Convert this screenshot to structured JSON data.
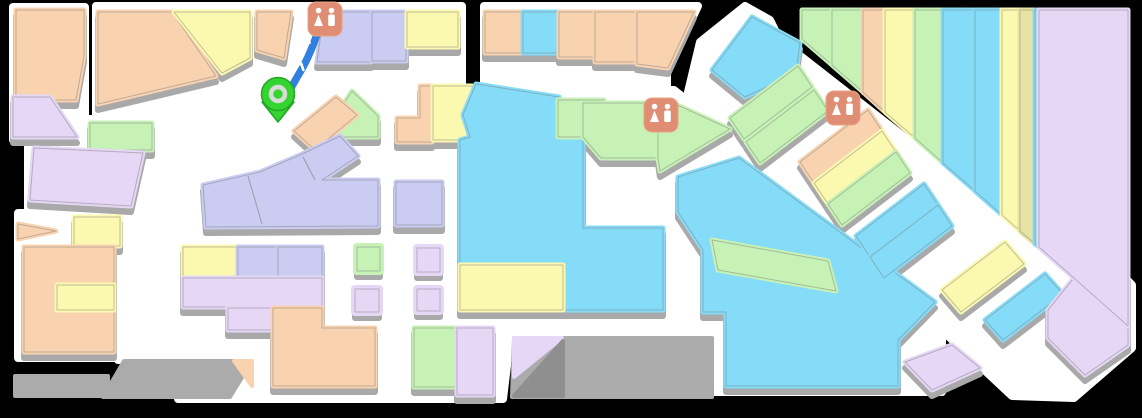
{
  "map": {
    "title": "mall-floor-map",
    "background": "#000000",
    "colors": {
      "peach": "#F9D3B0",
      "yellow": "#FBF8AF",
      "peri": "#CACCF2",
      "lilac": "#E7D7F6",
      "green": "#C7F2B6",
      "blue": "#85DCF8",
      "khaki": "#E6E3A3",
      "gray": "#ABABAB",
      "graydark": "#8F8F8F",
      "white": "#FFFFFF",
      "shadow": "#A9A9A9",
      "outline": "rgba(120,120,120,0.45)",
      "route": "#2F80E0",
      "pin": "#35D531",
      "pin_dark": "#23A623",
      "pin_ring": "#DADADA",
      "restroom_bg": "#DF8E73",
      "restroom_border": "#EBA184",
      "restroom_glyph": "#FFFFFF"
    },
    "floors": [
      {
        "p": "13,7 85,7 85,140 13,140"
      },
      {
        "p": "87,119 156,119 156,153 87,153"
      },
      {
        "p": "28,145 148,145 148,210 28,210"
      },
      {
        "p": "18,213 126,213 126,358 18,358"
      },
      {
        "p": "96,6 256,6 256,170 152,170 96,118"
      },
      {
        "p": "250,6 462,6 462,108 250,108"
      },
      {
        "p": "484,6 698,6 667,72 667,105 484,105"
      },
      {
        "p": "118,100 714,100 714,340 510,340 503,399 178,399 178,360 118,360"
      },
      {
        "p": "556,90 674,90 745,146 942,288 942,392 698,392 698,312 658,312 658,232 581,232 581,142 556,142"
      },
      {
        "p": "700,42 745,6 770,20 780,40 1072,268 1110,262 1132,285 1132,348 1074,398 1012,396 688,92"
      }
    ],
    "ramps": [
      {
        "c": "gray",
        "p": "15,376 108,376 108,396 15,396"
      },
      {
        "c": "gray",
        "p": "124,361 252,361 230,397 103,397"
      },
      {
        "c": "peach",
        "p": "234,361 252,361 252,386"
      },
      {
        "c": "gray",
        "p": "514,338 712,338 712,397 512,397"
      },
      {
        "c": "lilac",
        "p": "514,338 562,338 514,377"
      },
      {
        "c": "graydark",
        "p": "514,396 563,341 563,396"
      }
    ],
    "blocks": [
      {
        "c": "peach",
        "p": "16,10 84,10 84,56 76,100 16,100"
      },
      {
        "c": "lilac",
        "p": "13,97 50,97 77,137 13,137"
      },
      {
        "c": "green",
        "p": "90,123 152,123 152,150 90,150"
      },
      {
        "c": "lilac",
        "p": "34,148 143,153 131,206 30,200"
      },
      {
        "c": "peach",
        "p": "18,224 56,231 18,239",
        "sh": 0
      },
      {
        "c": "yellow",
        "p": "74,217 120,217 120,246 74,246"
      },
      {
        "c": "peach",
        "p": "24,247 114,247 114,352 24,352"
      },
      {
        "c": "yellow",
        "p": "57,285 114,285 114,310 57,310",
        "sh": 0
      },
      {
        "c": "peach",
        "p": "98,12 172,12 216,76 98,104"
      },
      {
        "c": "yellow",
        "p": "174,12 250,12 250,58 222,73"
      },
      {
        "c": "peach",
        "p": "257,12 291,12 284,58 257,50"
      },
      {
        "c": "peri",
        "p": "324,12 371,12 371,62 317,62"
      },
      {
        "c": "peri",
        "p": "372,12 406,12 406,61 372,61"
      },
      {
        "c": "yellow",
        "p": "407,12 458,12 458,47 407,47"
      },
      {
        "c": "green",
        "p": "352,91 378,116 378,137 322,137"
      },
      {
        "c": "peach",
        "p": "294,131 336,97 357,115 315,150"
      },
      {
        "c": "peri",
        "p": "203,185 260,172 300,155 340,136 358,156 322,180 378,180 378,226 206,227"
      },
      {
        "c": "peri",
        "p": "396,182 442,182 442,225 396,225"
      },
      {
        "c": "peach",
        "p": "420,86 432,86 432,142 397,142 397,118 420,118"
      },
      {
        "c": "yellow",
        "p": "433,86 472,86 472,140 433,140"
      },
      {
        "c": "blue",
        "p": "476,84 559,97 559,137 583,137 583,228 663,228 663,310 460,310 460,140 470,137 463,115"
      },
      {
        "c": "yellow",
        "p": "460,265 563,265 563,310 460,310",
        "sh": 0
      },
      {
        "c": "green",
        "p": "558,100 604,100 604,137 558,137",
        "sh": 0
      },
      {
        "c": "green",
        "p": "583,103 657,103 657,158 601,158 583,137"
      },
      {
        "c": "green",
        "p": "658,106 673,103 730,129 660,171 658,158"
      },
      {
        "c": "blue",
        "p": "678,177 739,158 935,302 898,340 898,386 726,386 726,312 703,312 703,250 678,212"
      },
      {
        "c": "green",
        "p": "712,240 828,261 836,291 718,270",
        "sh": 0
      },
      {
        "c": "peach",
        "p": "485,12 522,12 522,53 485,53"
      },
      {
        "c": "blue",
        "p": "523,12 558,12 558,53 523,53"
      },
      {
        "c": "peach",
        "p": "559,12 594,12 594,57 559,57"
      },
      {
        "c": "peach",
        "p": "595,12 636,12 636,62 595,62"
      },
      {
        "c": "peach",
        "p": "637,12 694,12 668,68 637,64"
      },
      {
        "c": "blue",
        "p": "712,70 752,17 800,43 796,73 745,97"
      },
      {
        "c": "green",
        "p": "730,118 798,66 812,87 744,139"
      },
      {
        "c": "green",
        "p": "746,142 814,90 828,111 760,163"
      },
      {
        "c": "peach",
        "p": "800,162 868,110 882,131 814,183"
      },
      {
        "c": "yellow",
        "p": "814,183 882,131 896,152 828,204"
      },
      {
        "c": "green",
        "p": "828,204 896,152 910,173 842,225"
      },
      {
        "c": "blue",
        "p": "856,236 924,184 938,205 870,257"
      },
      {
        "c": "blue",
        "p": "870,257 938,205 952,226 884,278"
      },
      {
        "c": "yellow",
        "p": "942,290 1005,242 1024,264 961,312"
      },
      {
        "c": "blue",
        "p": "985,320 1045,274 1063,294 1003,340"
      },
      {
        "c": "lilac",
        "p": "1048,310 1090,258 1115,258 1128,275 1128,345 1085,375 1048,338"
      },
      {
        "c": "lilac",
        "p": "905,362 952,345 980,368 932,390"
      },
      {
        "c": "green",
        "p": "802,10 831,10 831,64 802,39",
        "sh": 0
      },
      {
        "c": "green",
        "p": "832,10 862,10 862,91 832,65",
        "sh": 0
      },
      {
        "c": "peach",
        "p": "863,10 884,10 884,111 863,92",
        "sh": 0
      },
      {
        "c": "yellow",
        "p": "885,10 914,10 914,137 885,112",
        "sh": 0
      },
      {
        "c": "green",
        "p": "915,10 942,10 942,162 915,138",
        "sh": 0
      },
      {
        "c": "blue",
        "p": "943,10 973,10 973,189 943,163",
        "sh": 0
      },
      {
        "c": "blue",
        "p": "975,10 1001,10 1001,214 975,191",
        "sh": 0
      },
      {
        "c": "yellow",
        "p": "1002,10 1019,10 1019,230 1002,215",
        "sh": 0
      },
      {
        "c": "khaki",
        "p": "1020,10 1034,10 1034,243 1020,231",
        "sh": 0
      },
      {
        "c": "blue",
        "p": "1035,10 1038,10 1038,246 1035,244",
        "sh": 0
      },
      {
        "c": "lilac",
        "p": "1039,10 1128,10 1128,326 1039,247",
        "sh": 0
      },
      {
        "c": "yellow",
        "p": "183,247 237,247 237,277 183,277"
      },
      {
        "c": "peri",
        "p": "238,247 277,247 277,277 238,277"
      },
      {
        "c": "peri",
        "p": "278,247 322,247 322,277 278,277"
      },
      {
        "c": "lilac",
        "p": "183,278 322,278 322,307 183,307"
      },
      {
        "c": "lilac",
        "p": "228,308 272,308 272,330 228,330"
      },
      {
        "c": "peach",
        "p": "273,308 322,308 322,328 375,328 375,386 273,386"
      },
      {
        "c": "green",
        "p": "357,247 380,247 380,271 357,271",
        "k": 1
      },
      {
        "c": "lilac",
        "p": "417,248 440,248 440,272 417,272",
        "k": 1
      },
      {
        "c": "lilac",
        "p": "355,289 379,289 379,312 355,312",
        "k": 1
      },
      {
        "c": "lilac",
        "p": "417,289 440,289 440,311 417,311",
        "k": 1
      },
      {
        "c": "green",
        "p": "414,328 457,328 457,387 414,387"
      },
      {
        "c": "lilac",
        "p": "457,328 493,328 493,395 457,395"
      }
    ],
    "dividers": [
      {
        "p": "248,176 262,224"
      },
      {
        "p": "303,157 315,180"
      }
    ],
    "route": {
      "path": "M 322,18 C 317,36 311,52 303,67 C 295,81 287,93 284,106",
      "chevrons": [
        {
          "x": 306,
          "y": 39,
          "r": 16
        },
        {
          "x": 300,
          "y": 66,
          "r": 20
        },
        {
          "x": 291,
          "y": 90,
          "r": 22
        }
      ]
    },
    "pin": {
      "x": 278,
      "y": 94
    },
    "restrooms": [
      {
        "x": 325,
        "y": 19
      },
      {
        "x": 661,
        "y": 115
      },
      {
        "x": 843,
        "y": 108
      }
    ]
  }
}
